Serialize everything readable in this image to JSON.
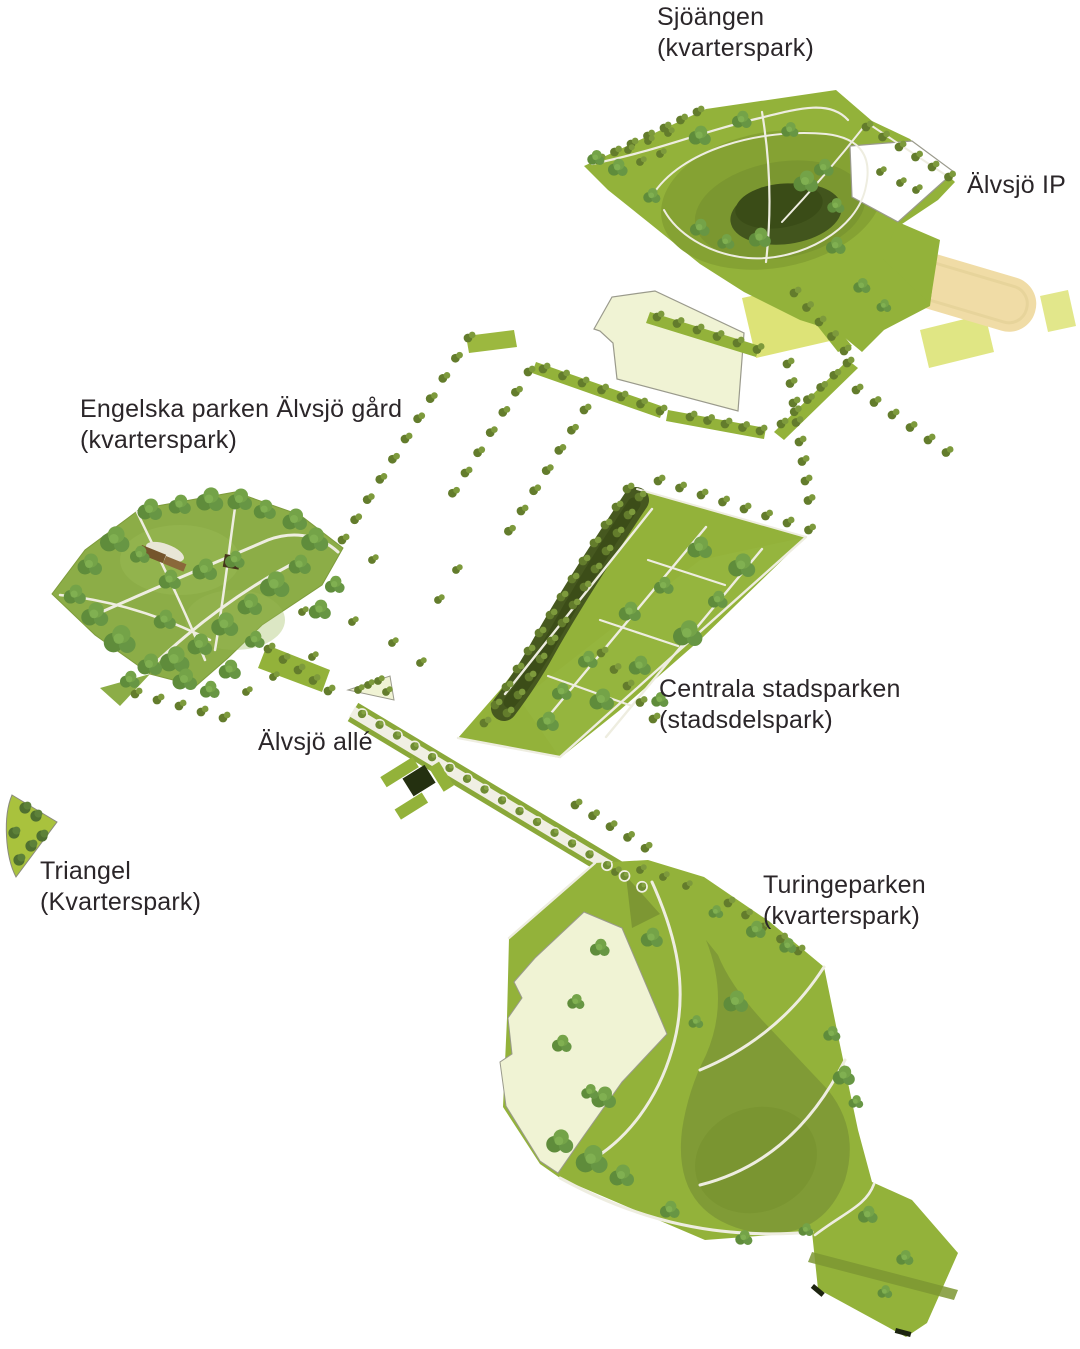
{
  "map": {
    "kind": "illustrative park plan",
    "labels": {
      "sjoangen": {
        "name": "Sjöängen",
        "qualifier": "(kvarterspark)"
      },
      "alvsjo_ip": {
        "name": "Älvsjö IP",
        "qualifier": ""
      },
      "engelska": {
        "name": "Engelska parken Älvsjö gård",
        "qualifier": "(kvarterspark)"
      },
      "centrala": {
        "name": "Centrala stadsparken",
        "qualifier": "(stadsdelspark)"
      },
      "alvsjo_alle": {
        "name": "Älvsjö allé",
        "qualifier": ""
      },
      "triangel": {
        "name": "Triangel",
        "qualifier": "(Kvarterspark)"
      },
      "turinge": {
        "name": "Turingeparken",
        "qualifier": "(kvarterspark)"
      }
    },
    "colors": {
      "background": "#ffffff",
      "label_text": "#2b2629",
      "park_green": "#93b23a",
      "lawn_green": "#8cad47",
      "meadow_dark": "#7e9a36",
      "pond_dark": "#42551d",
      "field_yellow_green": "#dde377",
      "field_pale_cream": "#f0f3d4",
      "sports_sand": "#f0dca6",
      "path_light": "#eeede0",
      "outline_grey": "#98988b",
      "building_brown": "#75552c"
    }
  }
}
